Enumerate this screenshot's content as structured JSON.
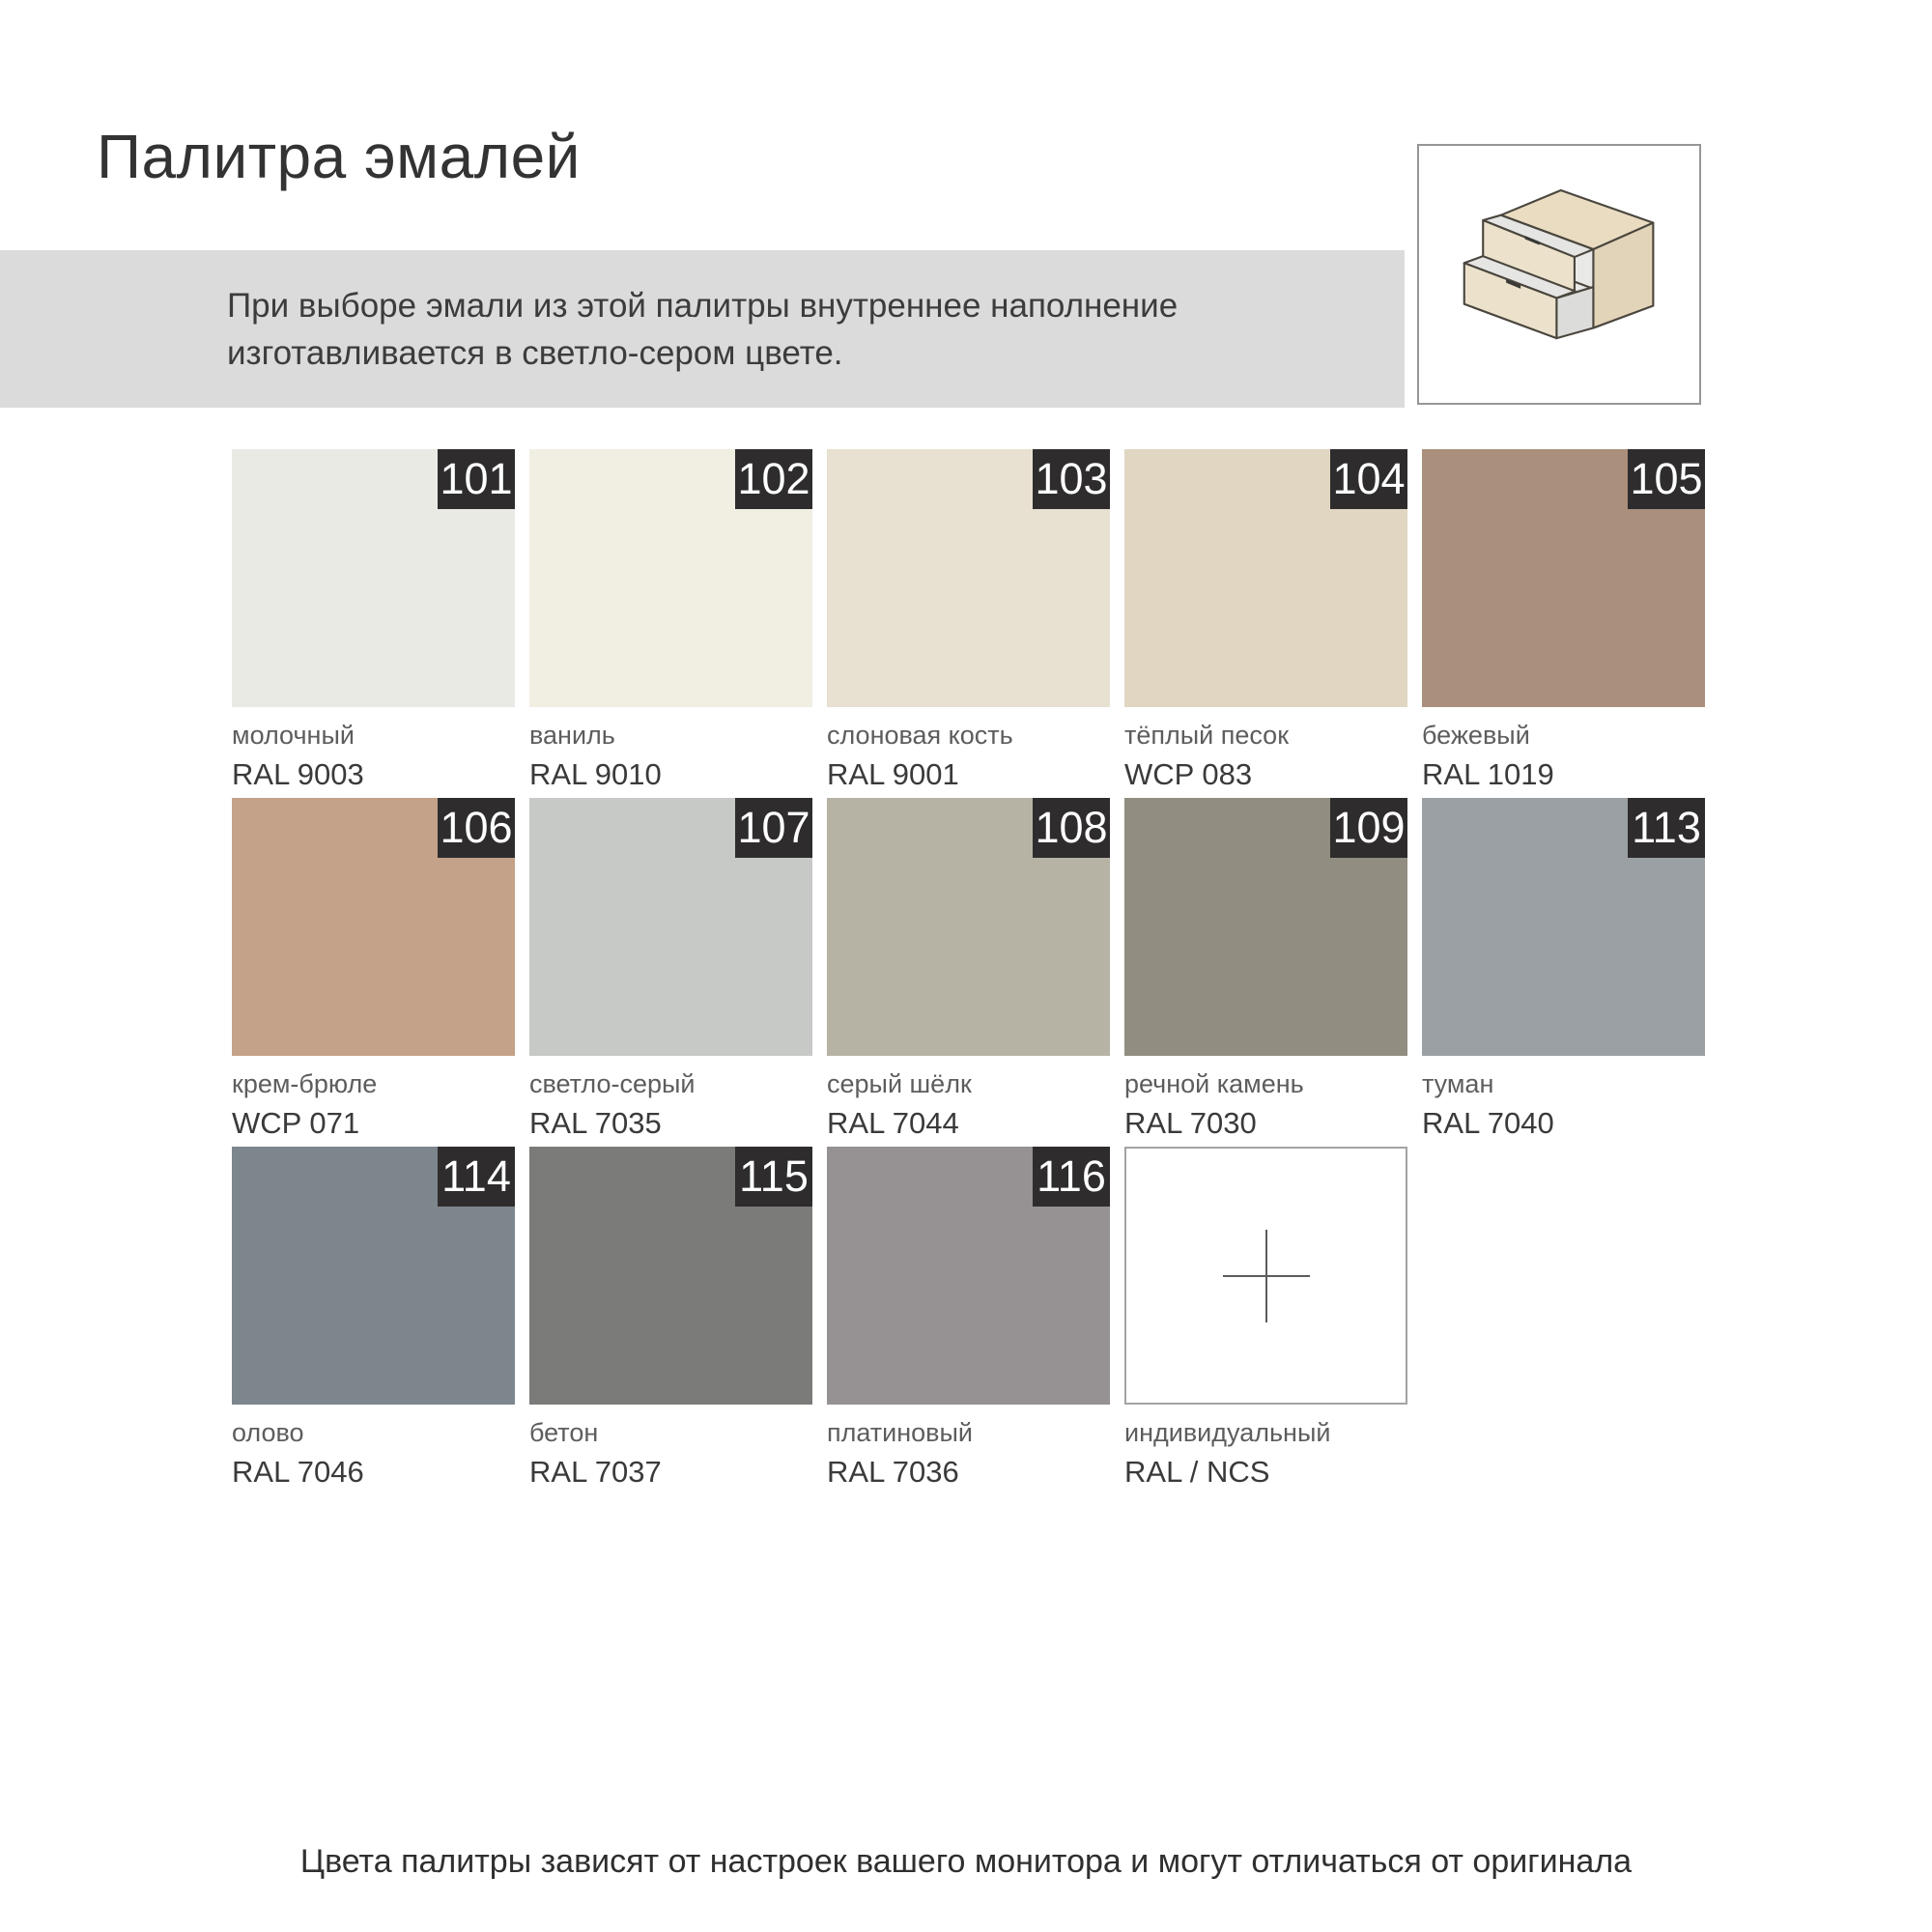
{
  "page": {
    "title": "Палитра эмалей",
    "note": "При выборе эмали из этой палитры внутреннее наполнение изготавливается в светло-сером цвете.",
    "footer": "Цвета палитры зависят от настроек вашего монитора и могут отличаться от оригинала"
  },
  "icon": {
    "name": "two-drawer-cabinet-icon",
    "front_color": "#ece2cc",
    "top_color": "#e9dcc1",
    "side_color": "#e2d4b8",
    "interior_color": "#e9e9e7",
    "outline_color": "#4a463e"
  },
  "colors": {
    "badge_bg": "#2e2c2d",
    "badge_text": "#ffffff",
    "note_bar_bg": "#dbdbdb",
    "custom_tile_border": "#a3a3a3"
  },
  "palette": {
    "swatches": [
      {
        "num": "101",
        "name": "молочный",
        "code": "RAL 9003",
        "color": "#e9eae4"
      },
      {
        "num": "102",
        "name": "ваниль",
        "code": "RAL 9010",
        "color": "#f1eee2"
      },
      {
        "num": "103",
        "name": "слоновая кость",
        "code": "RAL 9001",
        "color": "#e8e0d0"
      },
      {
        "num": "104",
        "name": "тёплый песок",
        "code": "WCP 083",
        "color": "#e0d6c2"
      },
      {
        "num": "105",
        "name": "бежевый",
        "code": "RAL 1019",
        "color": "#a98f7c"
      },
      {
        "num": "106",
        "name": "крем-брюле",
        "code": "WCP 071",
        "color": "#c3a289"
      },
      {
        "num": "107",
        "name": "светло-серый",
        "code": "RAL 7035",
        "color": "#c6c9c5"
      },
      {
        "num": "108",
        "name": "серый шёлк",
        "code": "RAL 7044",
        "color": "#b6b3a5"
      },
      {
        "num": "109",
        "name": "речной камень",
        "code": "RAL 7030",
        "color": "#918d80"
      },
      {
        "num": "113",
        "name": "туман",
        "code": "RAL 7040",
        "color": "#9ba0a4"
      },
      {
        "num": "114",
        "name": "олово",
        "code": "RAL 7046",
        "color": "#7d868d"
      },
      {
        "num": "115",
        "name": "бетон",
        "code": "RAL 7037",
        "color": "#7b7b79"
      },
      {
        "num": "116",
        "name": "платиновый",
        "code": "RAL 7036",
        "color": "#969192"
      },
      {
        "num": "",
        "name": "индивидуальный",
        "code": "RAL / NCS",
        "color": "#ffffff",
        "custom": true
      }
    ]
  }
}
